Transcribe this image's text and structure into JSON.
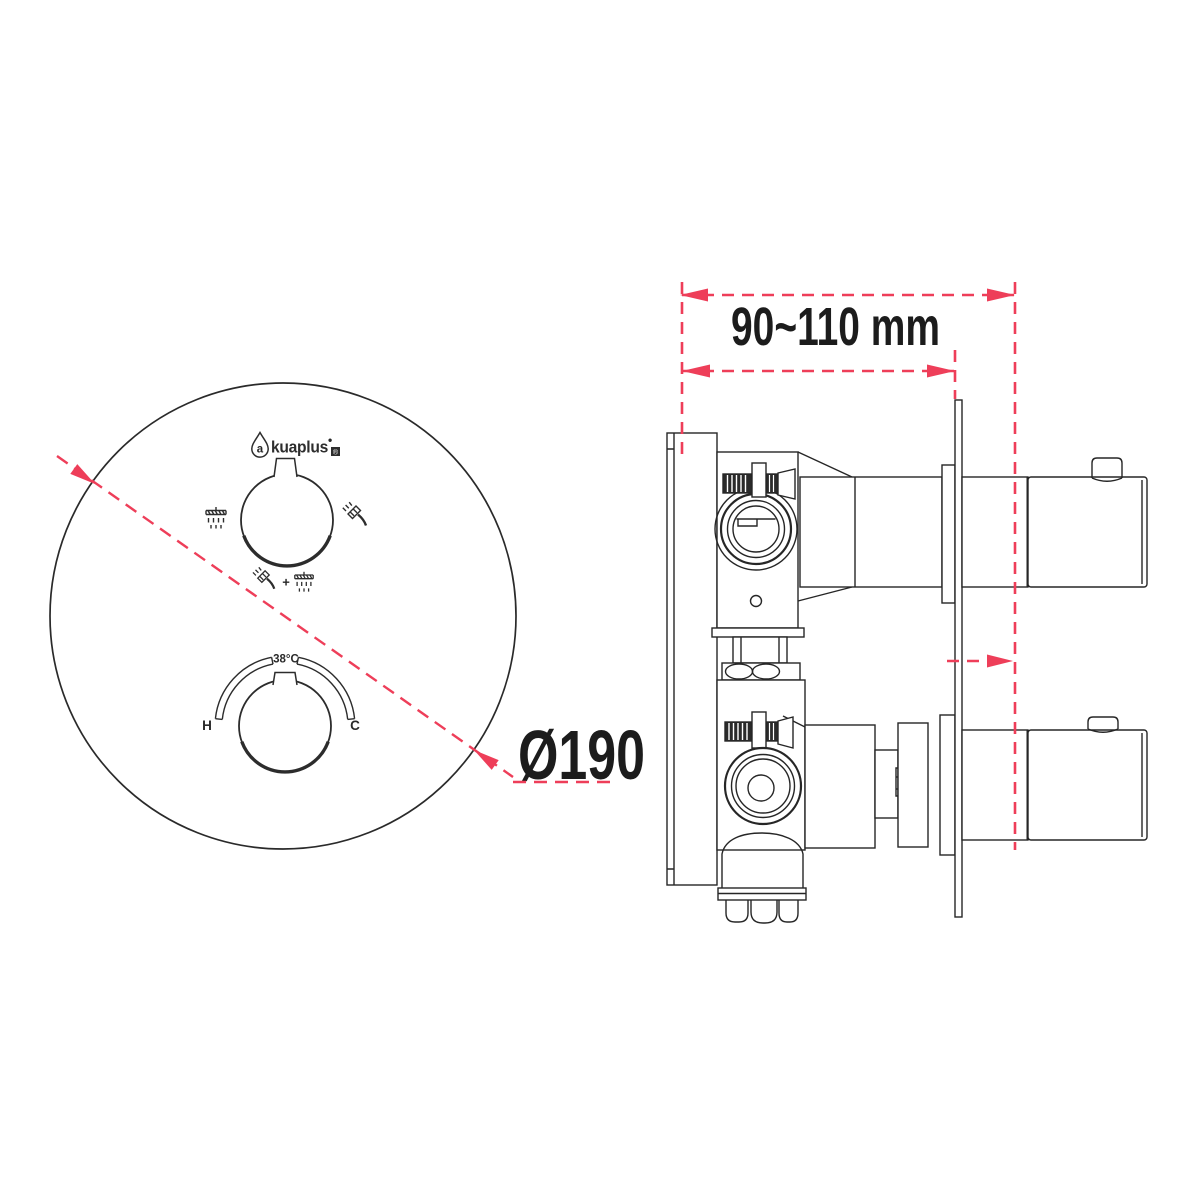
{
  "colors": {
    "ink": "#262626",
    "dimension_red": "#ee3e59",
    "background": "#ffffff"
  },
  "front_view": {
    "brand": {
      "name": "akuaplus",
      "droplet_letter": "a",
      "name_rest": "kuaplus",
      "bullet": "•",
      "mark": "®"
    },
    "diverter_knob": {
      "left_icon": "overhead-shower",
      "right_icon": "hand-shower",
      "bottom_icon": "hand-shower-plus-overhead-shower",
      "plus_sign": "+"
    },
    "temperature_knob": {
      "safety_stop_label": "38°C",
      "hot_label": "H",
      "cold_label": "C"
    },
    "diameter_label": "Ø190"
  },
  "side_view": {
    "depth_range_label": "90~110 mm"
  }
}
